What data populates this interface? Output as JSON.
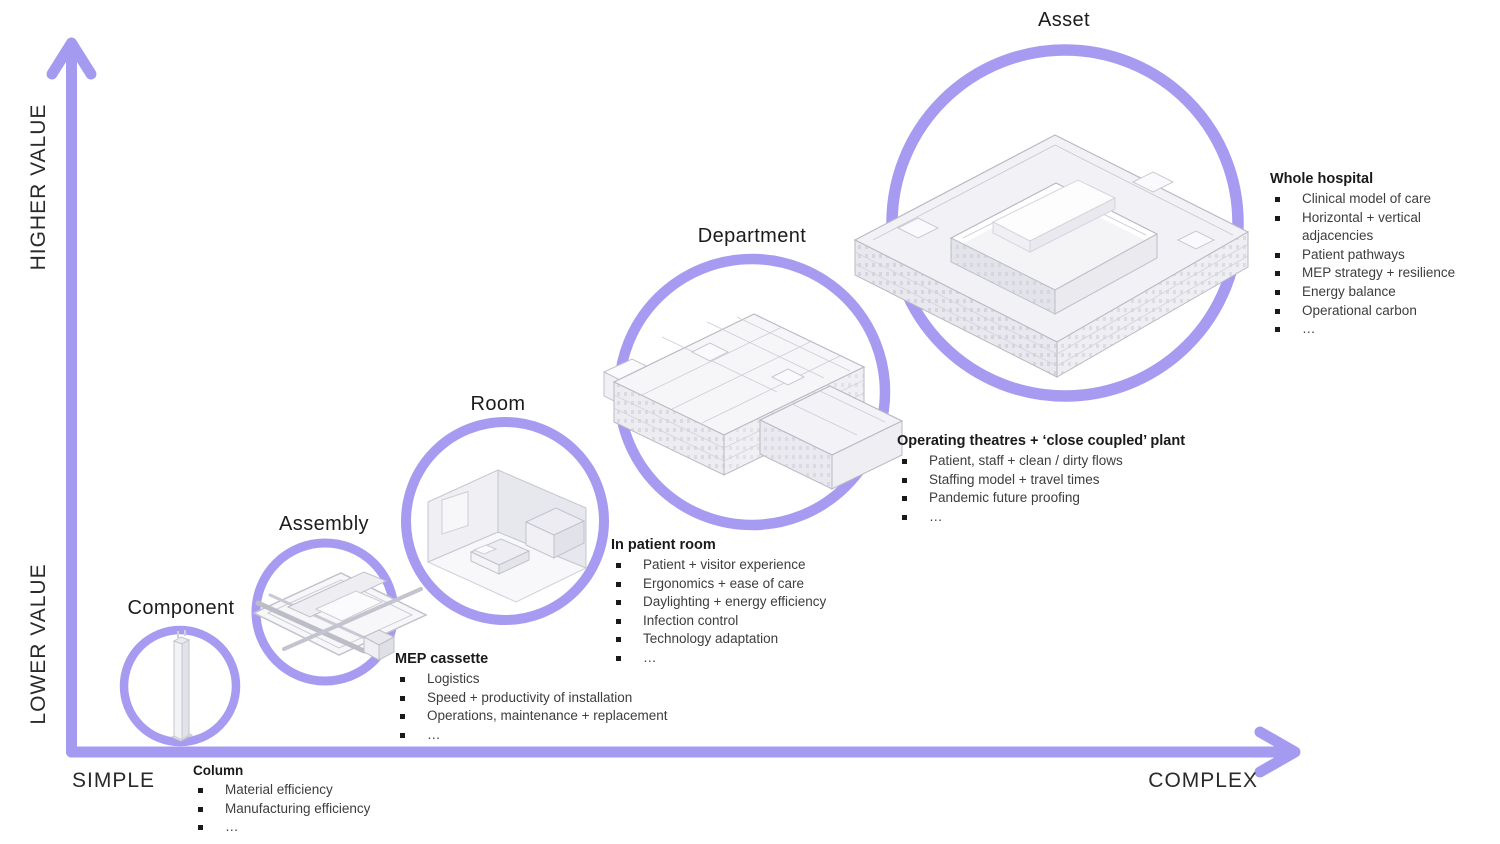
{
  "axes": {
    "higher": "HIGHER VALUE",
    "lower": "LOWER VALUE",
    "simple": "SIMPLE",
    "complex": "COMPLEX"
  },
  "colors": {
    "accent_purple": "#A49AF0",
    "circle_purple": "#A79BF1",
    "heading_text": "#1a1a1a",
    "body_text": "#3d3d3d"
  },
  "stages": [
    {
      "title": "Component",
      "list_title": "Column",
      "items": [
        "Material efficiency",
        "Manufacturing efficiency",
        "…"
      ]
    },
    {
      "title": "Assembly",
      "list_title": "MEP cassette",
      "items": [
        "Logistics",
        "Speed + productivity of installation",
        "Operations, maintenance + replacement",
        "…"
      ]
    },
    {
      "title": "Room",
      "list_title": "In patient room",
      "items": [
        "Patient + visitor experience",
        "Ergonomics + ease of care",
        "Daylighting + energy efficiency",
        "Infection control",
        "Technology adaptation",
        "…"
      ]
    },
    {
      "title": "Department",
      "list_title": "Operating theatres + ‘close coupled’ plant",
      "items": [
        "Patient, staff + clean / dirty flows",
        "Staffing model + travel times",
        "Pandemic future proofing",
        "…"
      ]
    },
    {
      "title": "Asset",
      "list_title": "Whole hospital",
      "items": [
        "Clinical model of care",
        "Horizontal + vertical adjacencies",
        "Patient pathways",
        "MEP strategy + resilience",
        "Energy balance",
        "Operational carbon",
        "…"
      ]
    }
  ]
}
